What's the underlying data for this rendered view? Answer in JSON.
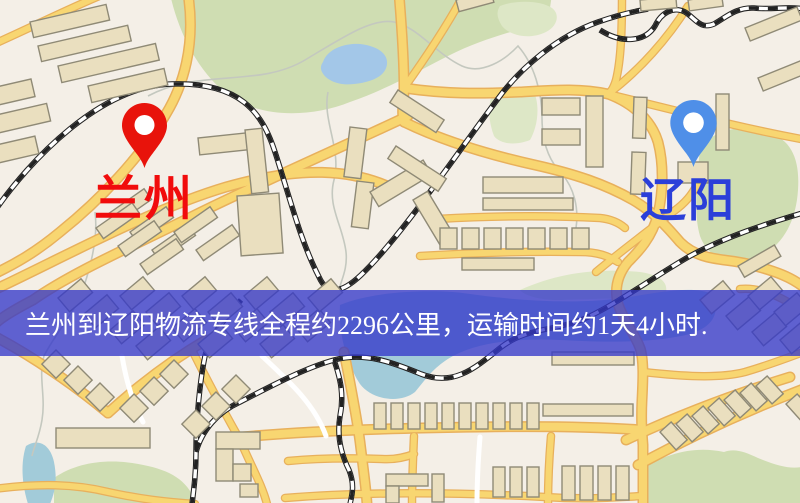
{
  "banner": {
    "text": "兰州到辽阳物流专线全程约2296公里，运输时间约1天4小时."
  },
  "markers": {
    "origin": {
      "label": "兰州"
    },
    "destination": {
      "label": "辽阳"
    }
  },
  "colors": {
    "map_bg": "#f4efe7",
    "park": "#cfddb2",
    "park_light": "#dde7c6",
    "water": "#a3c7e8",
    "water_teal": "#a2cbd9",
    "road_fill": "#f8d671",
    "road_casing": "#e8b05c",
    "minor_road": "#ffffff",
    "building": "#eadfbf",
    "building_stroke": "#8f8a76",
    "railway": "#222222",
    "stream": "#c4c8bf",
    "banner_bg": "rgba(53,56,201,0.78)",
    "banner_text": "#ffffff",
    "origin_pin": "#e8130b",
    "origin_label": "#f10c0c",
    "dest_pin": "#4f8fe8",
    "dest_label": "#2b3fd9"
  }
}
